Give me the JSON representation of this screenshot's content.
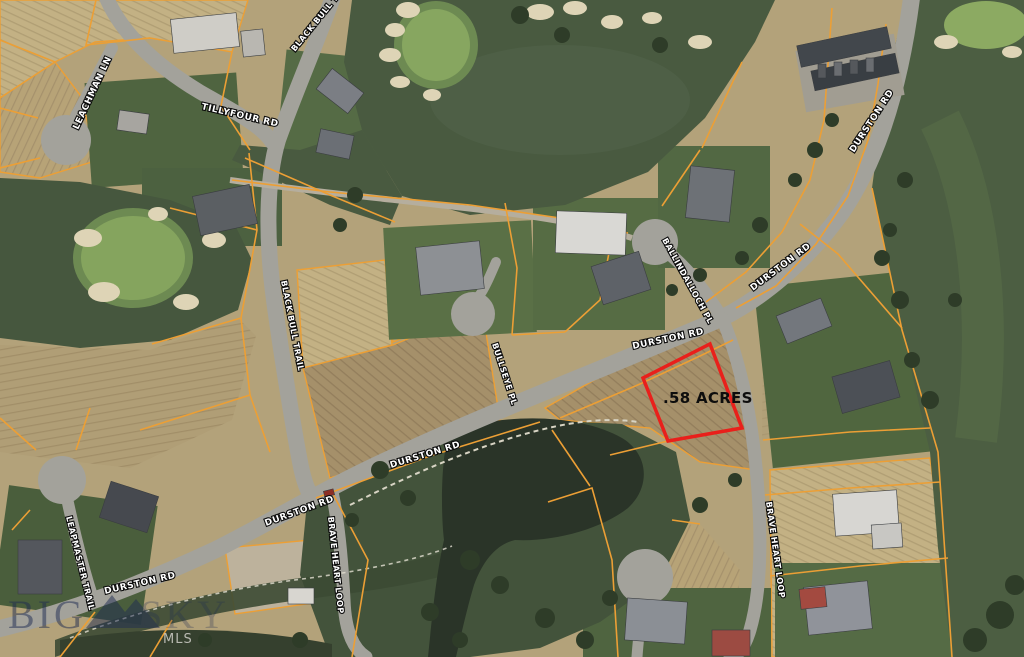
{
  "map": {
    "type": "aerial-parcel-map",
    "highlighted_lot": {
      "label": ".58 ACRES",
      "outline_color": "#e9201b"
    },
    "road_labels": [
      {
        "id": "leachman-ln",
        "text": "LEACHMAN LN"
      },
      {
        "id": "tillyfour-rd",
        "text": "TILLYFOUR RD"
      },
      {
        "id": "black-bull-trail-north",
        "text": "BLACK BULL TRAIL"
      },
      {
        "id": "black-bull-trail-mid",
        "text": "BLACK BULL TRAIL"
      },
      {
        "id": "ballindalloch-pl",
        "text": "BALLINDALLOCH PL"
      },
      {
        "id": "durston-rd-northeast",
        "text": "DURSTON RD"
      },
      {
        "id": "durston-rd-intersection",
        "text": "DURSTON RD"
      },
      {
        "id": "bullseye-pl",
        "text": "BULLSEYE PL"
      },
      {
        "id": "durston-rd-mid",
        "text": "DURSTON RD"
      },
      {
        "id": "durston-rd-upper",
        "text": "DURSTON RD"
      },
      {
        "id": "leapmaster-trail",
        "text": "LEAPMASTER TRAIL"
      },
      {
        "id": "durston-rd-southwest",
        "text": "DURSTON RD"
      },
      {
        "id": "durston-rd-braveheart",
        "text": "DURSTON RD"
      },
      {
        "id": "brave-heart-loop-west",
        "text": "BRAVE HEART LOOP"
      },
      {
        "id": "brave-heart-loop-east",
        "text": "BRAVE HEART LOOP"
      }
    ],
    "watermark": {
      "brand_word_1": "BIG",
      "brand_word_2": "SKY",
      "mls_text": "MLS"
    },
    "palette": {
      "field_tan": "#b3a27a",
      "golf_green": "#495a40",
      "putting_green": "#87a660",
      "road_gray": "#a3a29b",
      "parcel_line_orange": "#ec9f35",
      "pond_dark": "#2a3428",
      "label_text": "#ffffff"
    }
  }
}
